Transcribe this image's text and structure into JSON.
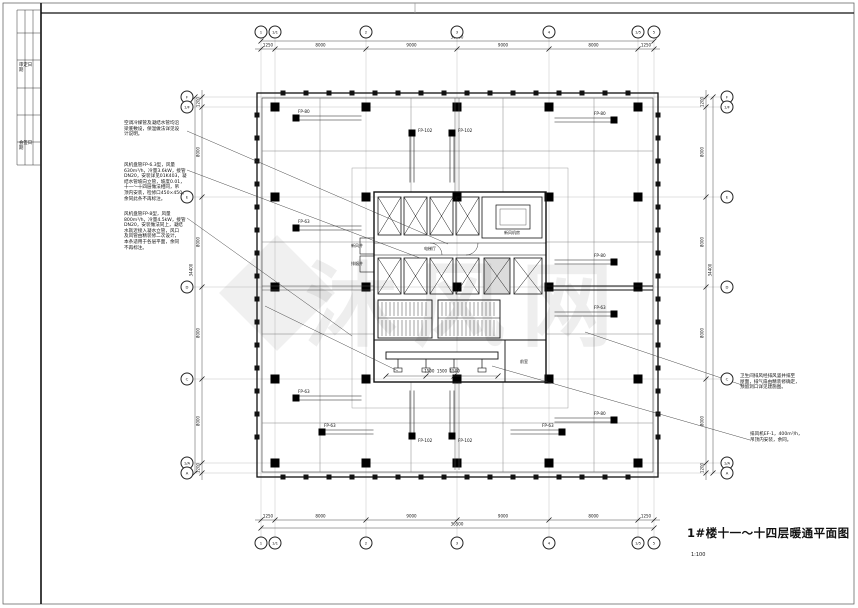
{
  "sheet": {
    "title": "1#楼十一～十四层暖通平面图",
    "scale": "1:100",
    "watermark_text": "沐风网"
  },
  "frame_table": {
    "cell_top": "审定日期",
    "cell_bottom": "会签日期"
  },
  "grid": {
    "top": [
      "1",
      "1/1",
      "2",
      "3",
      "4",
      "1/5",
      "5"
    ],
    "bottom": [
      "1",
      "1/1",
      "2",
      "3",
      "4",
      "1/5",
      "5"
    ],
    "left": [
      "F",
      "1/F",
      "E",
      "D",
      "C",
      "1/A",
      "A"
    ],
    "right": [
      "F",
      "1/F",
      "E",
      "D",
      "C",
      "1/A",
      "A"
    ]
  },
  "dims": {
    "top": [
      "1250",
      "8000",
      "9000",
      "9000",
      "8000",
      "1250"
    ],
    "top_total": "36500",
    "bottom": [
      "1250",
      "8000",
      "9000",
      "9000",
      "8000",
      "1250"
    ],
    "bottom_total": "36500",
    "left": [
      "1200",
      "8000",
      "8000",
      "8000",
      "8000",
      "1200"
    ],
    "left_total": "34400",
    "right": [
      "1200",
      "8000",
      "8000",
      "8000",
      "8000",
      "1200"
    ],
    "right_total": "34400"
  },
  "notes": {
    "left1": "空调冷媒管及凝结水管均沿\n梁底敷设，保温做法详见设\n计说明。",
    "left2": "风机盘管FP-6.3型，风量\n630m³/h，冷量3.6kW，接管\nDN20，安装详见01K403，凝\n结水管坡向立管，坡度0.01，\n十一～十四层做法相同，吊\n顶内安装，检修口450×450，\n余同此条不再标注。",
    "left3": "风机盘管FP-8型，风量\n800m³/h，冷量4.5kW，接管\nDN20，安装做法同上，凝结\n水就近接入凝水立管，风口\n及风管由精装修二次设计，\n本条适用于各层平面，余同\n不再标注。",
    "right1": "卫生间排风经排风竖井排至\n屋面，排气扇由精装修确定，\n预留洞口详见建施图。",
    "right2": "排风机EF-1，400m³/h，\n吊顶内安装，余同。"
  },
  "units": [
    {
      "label": "FP-80",
      "x": 296,
      "y": 118,
      "dir": "r",
      "len": 62
    },
    {
      "label": "FP-63",
      "x": 296,
      "y": 228,
      "dir": "r",
      "len": 62
    },
    {
      "label": "FP-63",
      "x": 296,
      "y": 398,
      "dir": "r",
      "len": 62
    },
    {
      "label": "FP-80",
      "x": 614,
      "y": 120,
      "dir": "l",
      "len": 56
    },
    {
      "label": "FP-80",
      "x": 614,
      "y": 262,
      "dir": "l",
      "len": 56
    },
    {
      "label": "FP-63",
      "x": 614,
      "y": 314,
      "dir": "l",
      "len": 56
    },
    {
      "label": "FP-80",
      "x": 614,
      "y": 420,
      "dir": "l",
      "len": 56
    },
    {
      "label": "FP-102",
      "x": 412,
      "y": 133,
      "dir": "d",
      "len": 46
    },
    {
      "label": "FP-102",
      "x": 452,
      "y": 133,
      "dir": "d",
      "len": 46
    },
    {
      "label": "FP-102",
      "x": 412,
      "y": 436,
      "dir": "u",
      "len": 42
    },
    {
      "label": "FP-102",
      "x": 452,
      "y": 436,
      "dir": "u",
      "len": 42
    },
    {
      "label": "FP-63",
      "x": 322,
      "y": 432,
      "dir": "r",
      "len": 48
    },
    {
      "label": "FP-63",
      "x": 562,
      "y": 432,
      "dir": "l",
      "len": 48
    }
  ],
  "floats": [
    {
      "text": "新风机房",
      "x": 512,
      "y": 233
    },
    {
      "text": "电梯厅",
      "x": 430,
      "y": 249
    },
    {
      "text": "前室",
      "x": 524,
      "y": 362
    },
    {
      "text": "新风井",
      "x": 357,
      "y": 246
    },
    {
      "text": "排烟井",
      "x": 357,
      "y": 264
    },
    {
      "text": "1500  1500  1500",
      "x": 442,
      "y": 371
    }
  ]
}
